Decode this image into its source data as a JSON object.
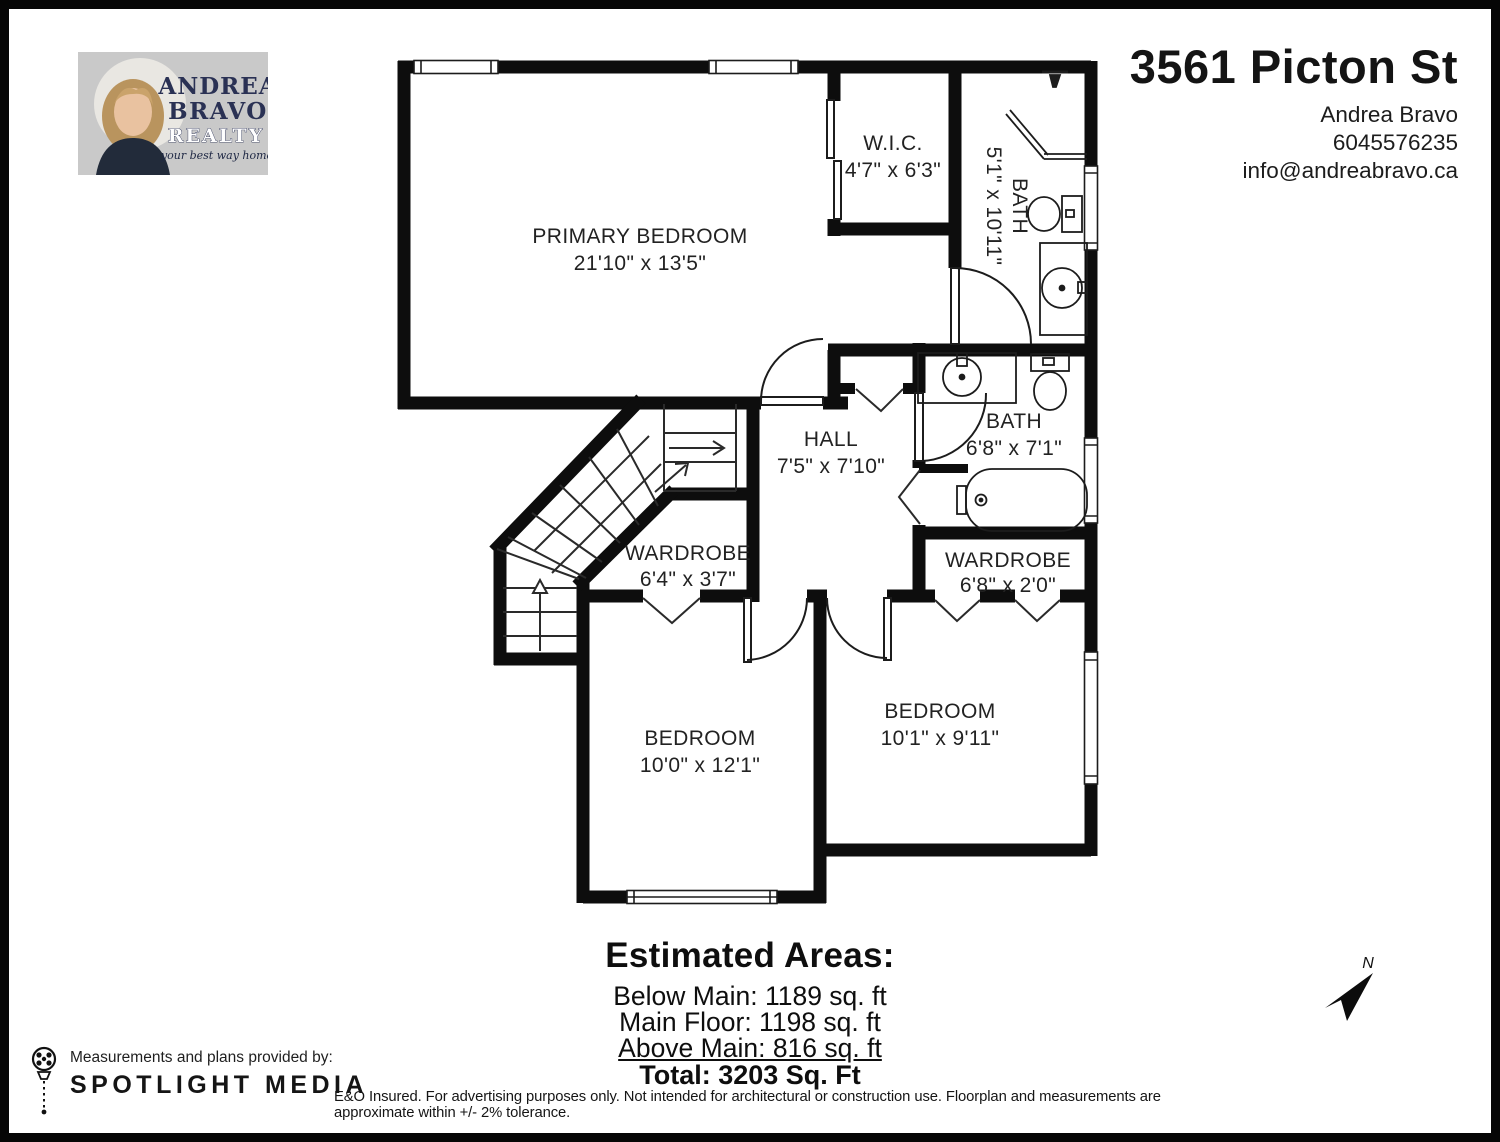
{
  "logo": {
    "name_line1": "ANDREA",
    "name_line2": "BRAVO",
    "realty": "REALTY",
    "tagline": "your best way home",
    "bg": "#c9c9c9",
    "navy": "#2a3154"
  },
  "header": {
    "address": "3561 Picton St",
    "agent": "Andrea Bravo",
    "phone": "6045576235",
    "email": "info@andreabravo.ca"
  },
  "floorplan": {
    "rooms": {
      "primary": {
        "name": "PRIMARY BEDROOM",
        "dims": "21'10\" x 13'5\""
      },
      "wic": {
        "name": "W.I.C.",
        "dims": "4'7\" x 6'3\""
      },
      "ensuite": {
        "name": "BATH",
        "dims": "5'1\" x 10'11\""
      },
      "hall": {
        "name": "HALL",
        "dims": "7'5\" x 7'10\""
      },
      "bath": {
        "name": "BATH",
        "dims": "6'8\" x 7'1\""
      },
      "wardrobe1": {
        "name": "WARDROBE",
        "dims": "6'4\" x 3'7\""
      },
      "wardrobe2": {
        "name": "WARDROBE",
        "dims": "6'8\" x 2'0\""
      },
      "bedroom1": {
        "name": "BEDROOM",
        "dims": "10'0\" x 12'1\""
      },
      "bedroom2": {
        "name": "BEDROOM",
        "dims": "10'1\" x 9'11\""
      }
    },
    "north_label": "N",
    "wall_color": "#0d0d0d"
  },
  "areas": {
    "title": "Estimated Areas:",
    "below_main": "Below Main: 1189 sq. ft",
    "main_floor": "Main Floor: 1198 sq. ft",
    "above_main": "Above Main: 816 sq. ft",
    "total": "Total: 3203 Sq. Ft"
  },
  "provider": {
    "prefix": "Measurements and plans provided by:",
    "name": "SPOTLIGHT MEDIA"
  },
  "disclaimer": "E&O Insured. For advertising purposes only. Not intended for architectural or construction use. Floorplan and measurements are approximate within +/- 2% tolerance."
}
